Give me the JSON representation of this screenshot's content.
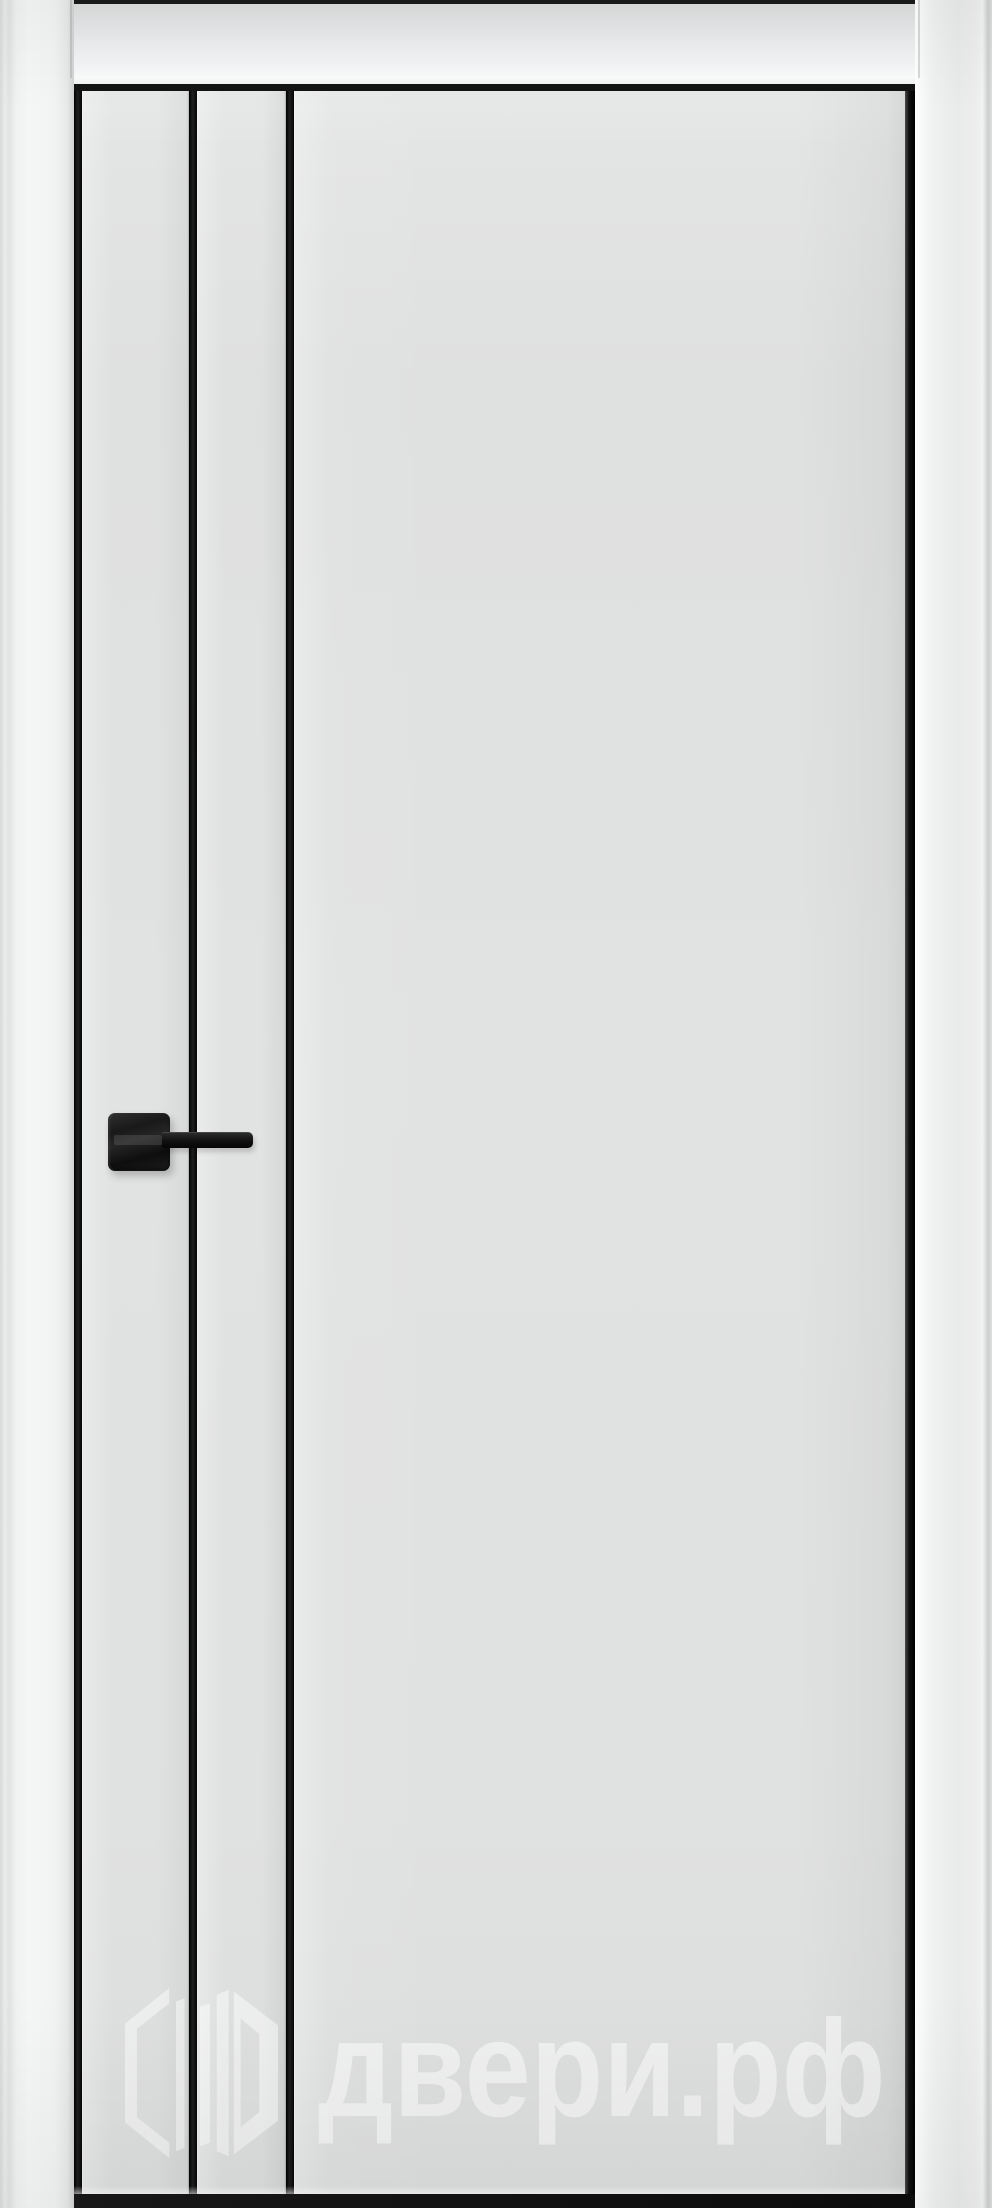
{
  "photo": {
    "subject": "closed white interior door in frame",
    "molding_lines": 3,
    "handle": "black lever handle on square rosette"
  },
  "watermark": {
    "text": "двери.рф",
    "logo": "dveri-rf-logo"
  },
  "colors": {
    "door_leaf": "#e0e1e1",
    "frame_casing": "#f3f4f4",
    "molding_black": "#161616",
    "handle_black": "#151515",
    "shadow_strip": "#1b1b1b",
    "watermark_white": "rgba(255,255,255,0.52)"
  }
}
